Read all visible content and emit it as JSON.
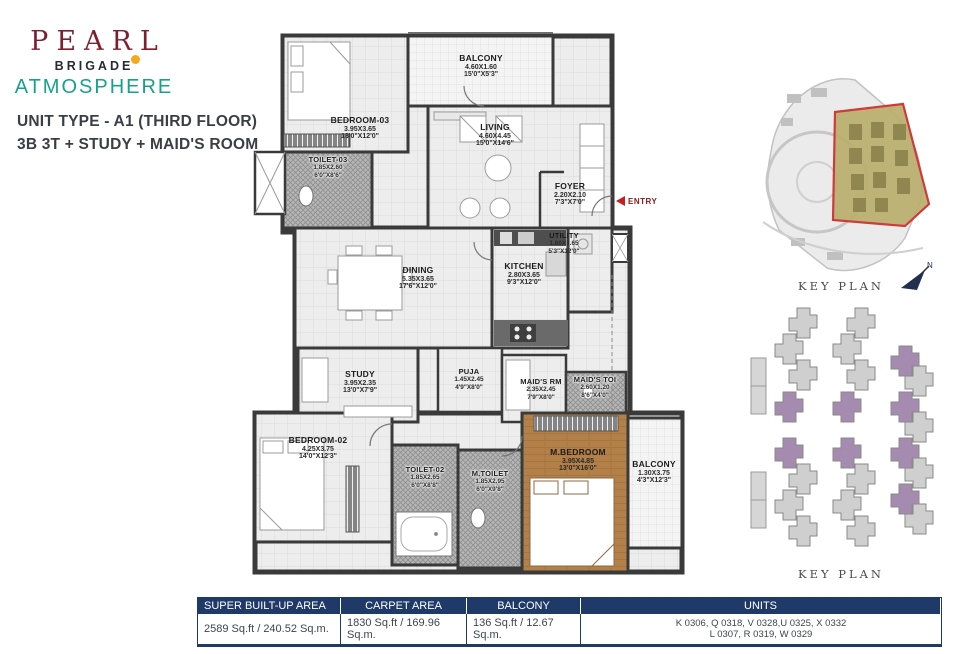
{
  "brand": {
    "name": "PEARL",
    "builder": "BRIGADE",
    "project": "ATMOSPHERE"
  },
  "unit_info": {
    "line1": "UNIT TYPE - A1 (THIRD FLOOR)",
    "line2": "3B 3T + STUDY + MAID'S ROOM"
  },
  "floorplan": {
    "entry_label": "ENTRY",
    "rooms": [
      {
        "name": "BALCONY",
        "dim_m": "4.60X1.60",
        "dim_ft": "15'0\"X5'3\""
      },
      {
        "name": "BEDROOM-03",
        "dim_m": "3.95X3.65",
        "dim_ft": "13'0\"X12'0\""
      },
      {
        "name": "TOILET-03",
        "dim_m": "1.85X2.60",
        "dim_ft": "6'0\"X8'6\""
      },
      {
        "name": "LIVING",
        "dim_m": "4.60X4.45",
        "dim_ft": "15'0\"X14'6\""
      },
      {
        "name": "FOYER",
        "dim_m": "2.20X2.10",
        "dim_ft": "7'3\"X7'0\""
      },
      {
        "name": "UTILITY",
        "dim_m": "1.60X3.65",
        "dim_ft": "5'3\"X12'0\""
      },
      {
        "name": "DINING",
        "dim_m": "5.35X3.65",
        "dim_ft": "17'6\"X12'0\""
      },
      {
        "name": "KITCHEN",
        "dim_m": "2.80X3.65",
        "dim_ft": "9'3\"X12'0\""
      },
      {
        "name": "STUDY",
        "dim_m": "3.95X2.35",
        "dim_ft": "13'0\"X7'9\""
      },
      {
        "name": "PUJA",
        "dim_m": "1.45X2.45",
        "dim_ft": "4'9\"X8'0\""
      },
      {
        "name": "MAID'S RM",
        "dim_m": "2.35X2.45",
        "dim_ft": "7'9\"X8'0\""
      },
      {
        "name": "MAID'S TOI",
        "dim_m": "2.60X1.20",
        "dim_ft": "8'6\"X4'0\""
      },
      {
        "name": "BEDROOM-02",
        "dim_m": "4.25X3.75",
        "dim_ft": "14'0\"X12'3\""
      },
      {
        "name": "TOILET-02",
        "dim_m": "1.85X2.65",
        "dim_ft": "6'0\"X8'8\""
      },
      {
        "name": "M.TOILET",
        "dim_m": "1.85X2.95",
        "dim_ft": "6'0\"X9'8\""
      },
      {
        "name": "M.BEDROOM",
        "dim_m": "3.95X4.85",
        "dim_ft": "13'0\"X16'0\""
      },
      {
        "name": "BALCONY",
        "dim_m": "1.30X3.75",
        "dim_ft": "4'3\"X12'3\""
      }
    ]
  },
  "keyplans": {
    "site_label": "KEY PLAN",
    "blocks_label": "KEY PLAN"
  },
  "area_table": {
    "headers": [
      "SUPER BUILT-UP AREA",
      "CARPET AREA",
      "BALCONY",
      "UNITS"
    ],
    "super_built_up": "2589 Sq.ft / 240.52 Sq.m.",
    "carpet": "1830 Sq.ft / 169.96 Sq.m.",
    "balcony": "136 Sq.ft / 12.67 Sq.m.",
    "units_line1": "K 0306, Q 0318, V 0328,U 0325,  X 0332",
    "units_line2": "L 0307, R 0319, W 0329"
  },
  "colors": {
    "accent_navy": "#1F3A68",
    "brand_maroon": "#7D1F2E",
    "brand_teal": "#17A08C",
    "brand_orange": "#F5A81C",
    "highlight_red": "#CF3A3A",
    "site_olive": "#B9AE6D",
    "block_purple": "#A58BB0",
    "wood": "#B28048"
  }
}
